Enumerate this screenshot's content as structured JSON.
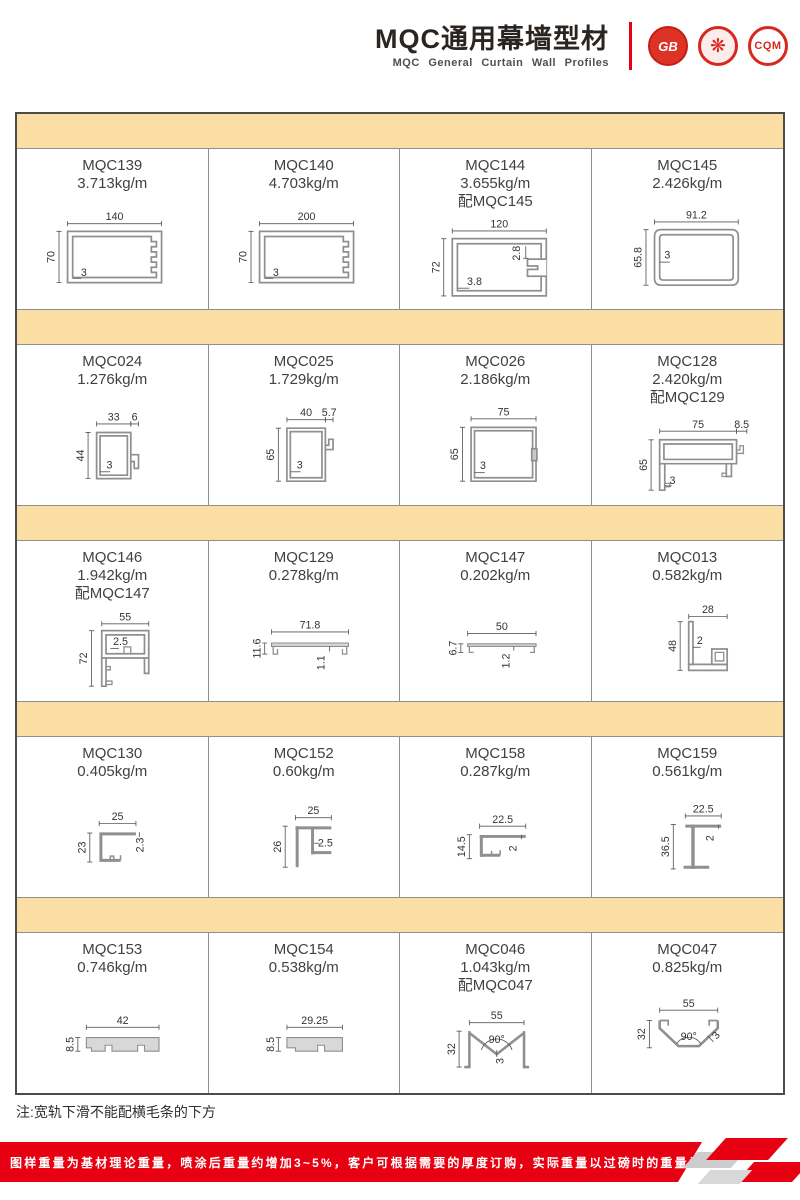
{
  "header": {
    "title_cn": "MQC通用幕墙型材",
    "title_en": "MQC General Curtain Wall Profiles",
    "logos": [
      {
        "label": "GB"
      },
      {
        "label": "❋"
      },
      {
        "label": "CQM"
      }
    ]
  },
  "grid": {
    "cells": [
      {
        "model": "MQC139",
        "weight": "3.713kg/m",
        "dims": {
          "top": "140",
          "left": "70",
          "wall": "3"
        }
      },
      {
        "model": "MQC140",
        "weight": "4.703kg/m",
        "dims": {
          "top": "200",
          "left": "70",
          "wall": "3"
        }
      },
      {
        "model": "MQC144",
        "weight": "3.655kg/m",
        "pair": "配MQC145",
        "dims": {
          "top": "120",
          "left": "72",
          "wall": "3.8",
          "inner": "2.8"
        }
      },
      {
        "model": "MQC145",
        "weight": "2.426kg/m",
        "dims": {
          "top": "91.2",
          "left": "65.8",
          "wall": "3"
        }
      },
      {
        "model": "MQC024",
        "weight": "1.276kg/m",
        "dims": {
          "top": "33",
          "ext": "6",
          "left": "44",
          "wall": "3"
        }
      },
      {
        "model": "MQC025",
        "weight": "1.729kg/m",
        "dims": {
          "top": "40",
          "ext": "5.7",
          "left": "65",
          "wall": "3"
        }
      },
      {
        "model": "MQC026",
        "weight": "2.186kg/m",
        "dims": {
          "top": "75",
          "left": "65",
          "wall": "3"
        }
      },
      {
        "model": "MQC128",
        "weight": "2.420kg/m",
        "pair": "配MQC129",
        "dims": {
          "top": "75",
          "ext": "8.5",
          "left": "65",
          "wall": "3"
        }
      },
      {
        "model": "MQC146",
        "weight": "1.942kg/m",
        "pair": "配MQC147",
        "dims": {
          "top": "55",
          "left": "72",
          "wall": "2.5"
        }
      },
      {
        "model": "MQC129",
        "weight": "0.278kg/m",
        "dims": {
          "top": "71.8",
          "left": "11.6",
          "wall": "1.1"
        }
      },
      {
        "model": "MQC147",
        "weight": "0.202kg/m",
        "dims": {
          "top": "50",
          "left": "6.7",
          "wall": "1.2"
        }
      },
      {
        "model": "MQC013",
        "weight": "0.582kg/m",
        "dims": {
          "top": "28",
          "left": "48",
          "wall": "2"
        }
      },
      {
        "model": "MQC130",
        "weight": "0.405kg/m",
        "dims": {
          "top": "25",
          "left": "23",
          "wall": "2.3"
        }
      },
      {
        "model": "MQC152",
        "weight": "0.60kg/m",
        "dims": {
          "top": "25",
          "left": "26",
          "wall": "2.5"
        }
      },
      {
        "model": "MQC158",
        "weight": "0.287kg/m",
        "dims": {
          "top": "22.5",
          "left": "14.5",
          "wall": "2"
        }
      },
      {
        "model": "MQC159",
        "weight": "0.561kg/m",
        "dims": {
          "top": "22.5",
          "left": "36.5",
          "wall": "2"
        }
      },
      {
        "model": "MQC153",
        "weight": "0.746kg/m",
        "dims": {
          "top": "42",
          "left": "8.5"
        }
      },
      {
        "model": "MQC154",
        "weight": "0.538kg/m",
        "dims": {
          "top": "29.25",
          "left": "8.5"
        }
      },
      {
        "model": "MQC046",
        "weight": "1.043kg/m",
        "pair": "配MQC047",
        "dims": {
          "top": "55",
          "left": "32",
          "angle": "90°",
          "wall": "3"
        }
      },
      {
        "model": "MQC047",
        "weight": "0.825kg/m",
        "dims": {
          "top": "55",
          "left": "32",
          "angle": "90°",
          "wall": "3"
        }
      }
    ]
  },
  "note": "注:宽轨下滑不能配横毛条的下方",
  "footer": {
    "disclaimer": "图样重量为基材理论重量，喷涂后重量约增加3~5%，客户可根据需要的厚度订购，实际重量以过磅时的重量为准。",
    "brand_line1": "JIAHUA",
    "brand_line2": "ALUMINIUM",
    "page": "31"
  },
  "colors": {
    "accent_red": "#e60012",
    "band": "#fbdea3"
  }
}
